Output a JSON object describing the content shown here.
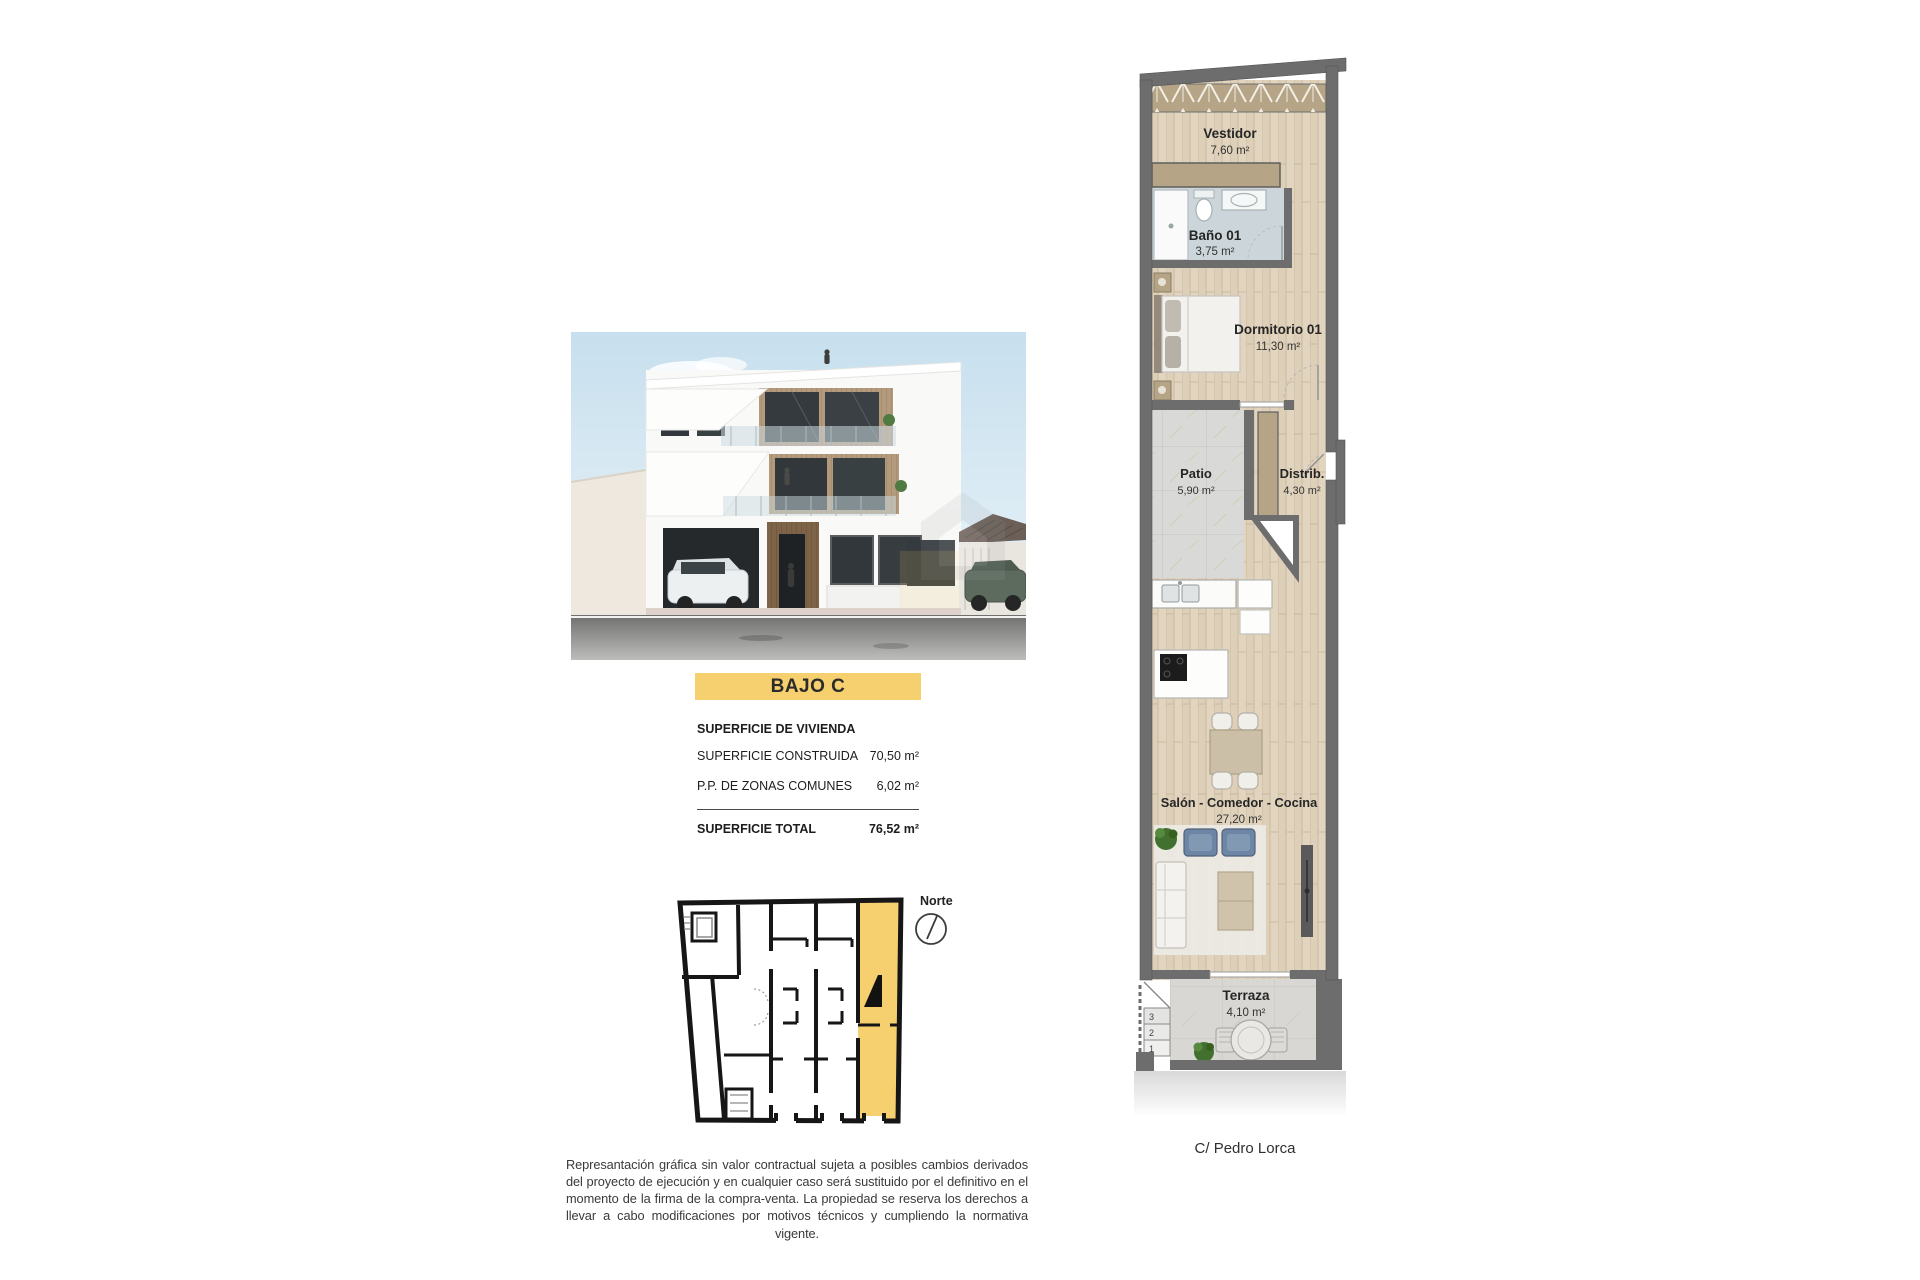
{
  "unit": {
    "banner": "BAJO C"
  },
  "areas": {
    "header": "SUPERFICIE DE VIVIENDA",
    "rows": [
      {
        "label": "SUPERFICIE CONSTRUIDA",
        "value": "70,50 m²"
      },
      {
        "label": "P.P. DE ZONAS COMUNES",
        "value": "6,02 m²"
      }
    ],
    "total": {
      "label": "SUPERFICIE TOTAL",
      "value": "76,52 m²"
    }
  },
  "compass": {
    "label": "Norte"
  },
  "floorplan": {
    "rooms": [
      {
        "name": "Vestidor",
        "area": "7,60 m²"
      },
      {
        "name": "Baño 01",
        "area": "3,75 m²"
      },
      {
        "name": "Dormitorio 01",
        "area": "11,30 m²"
      },
      {
        "name": "Patio",
        "area": "5,90 m²"
      },
      {
        "name": "Distrib.",
        "area": "4,30 m²"
      },
      {
        "name": "Salón - Comedor - Cocina",
        "area": "27,20 m²"
      },
      {
        "name": "Terraza",
        "area": "4,10 m²"
      }
    ],
    "step_numbers": [
      "3",
      "2",
      "1"
    ],
    "street": "C/ Pedro Lorca"
  },
  "disclaimer": "Represantación gráfica sin valor contractual sujeta a posibles cambios derivados del proyecto de ejecución y en cualquier caso será sustituido por el definitivo en el momento de la firma de la compra-venta. La propiedad se reserva los derechos a llevar a cabo modificaciones por motivos técnicos y cumpliendo la normativa vigente.",
  "colors": {
    "highlight": "#f6d06e",
    "wall": "#6d6d6d",
    "wood_floor": "#ddcfb8",
    "closet_tan": "#b5a485",
    "bath_floor": "#ccd6da",
    "tile_gray": "#dadad8",
    "armchair_blue": "#6d86a5",
    "plant_green": "#41702f"
  }
}
